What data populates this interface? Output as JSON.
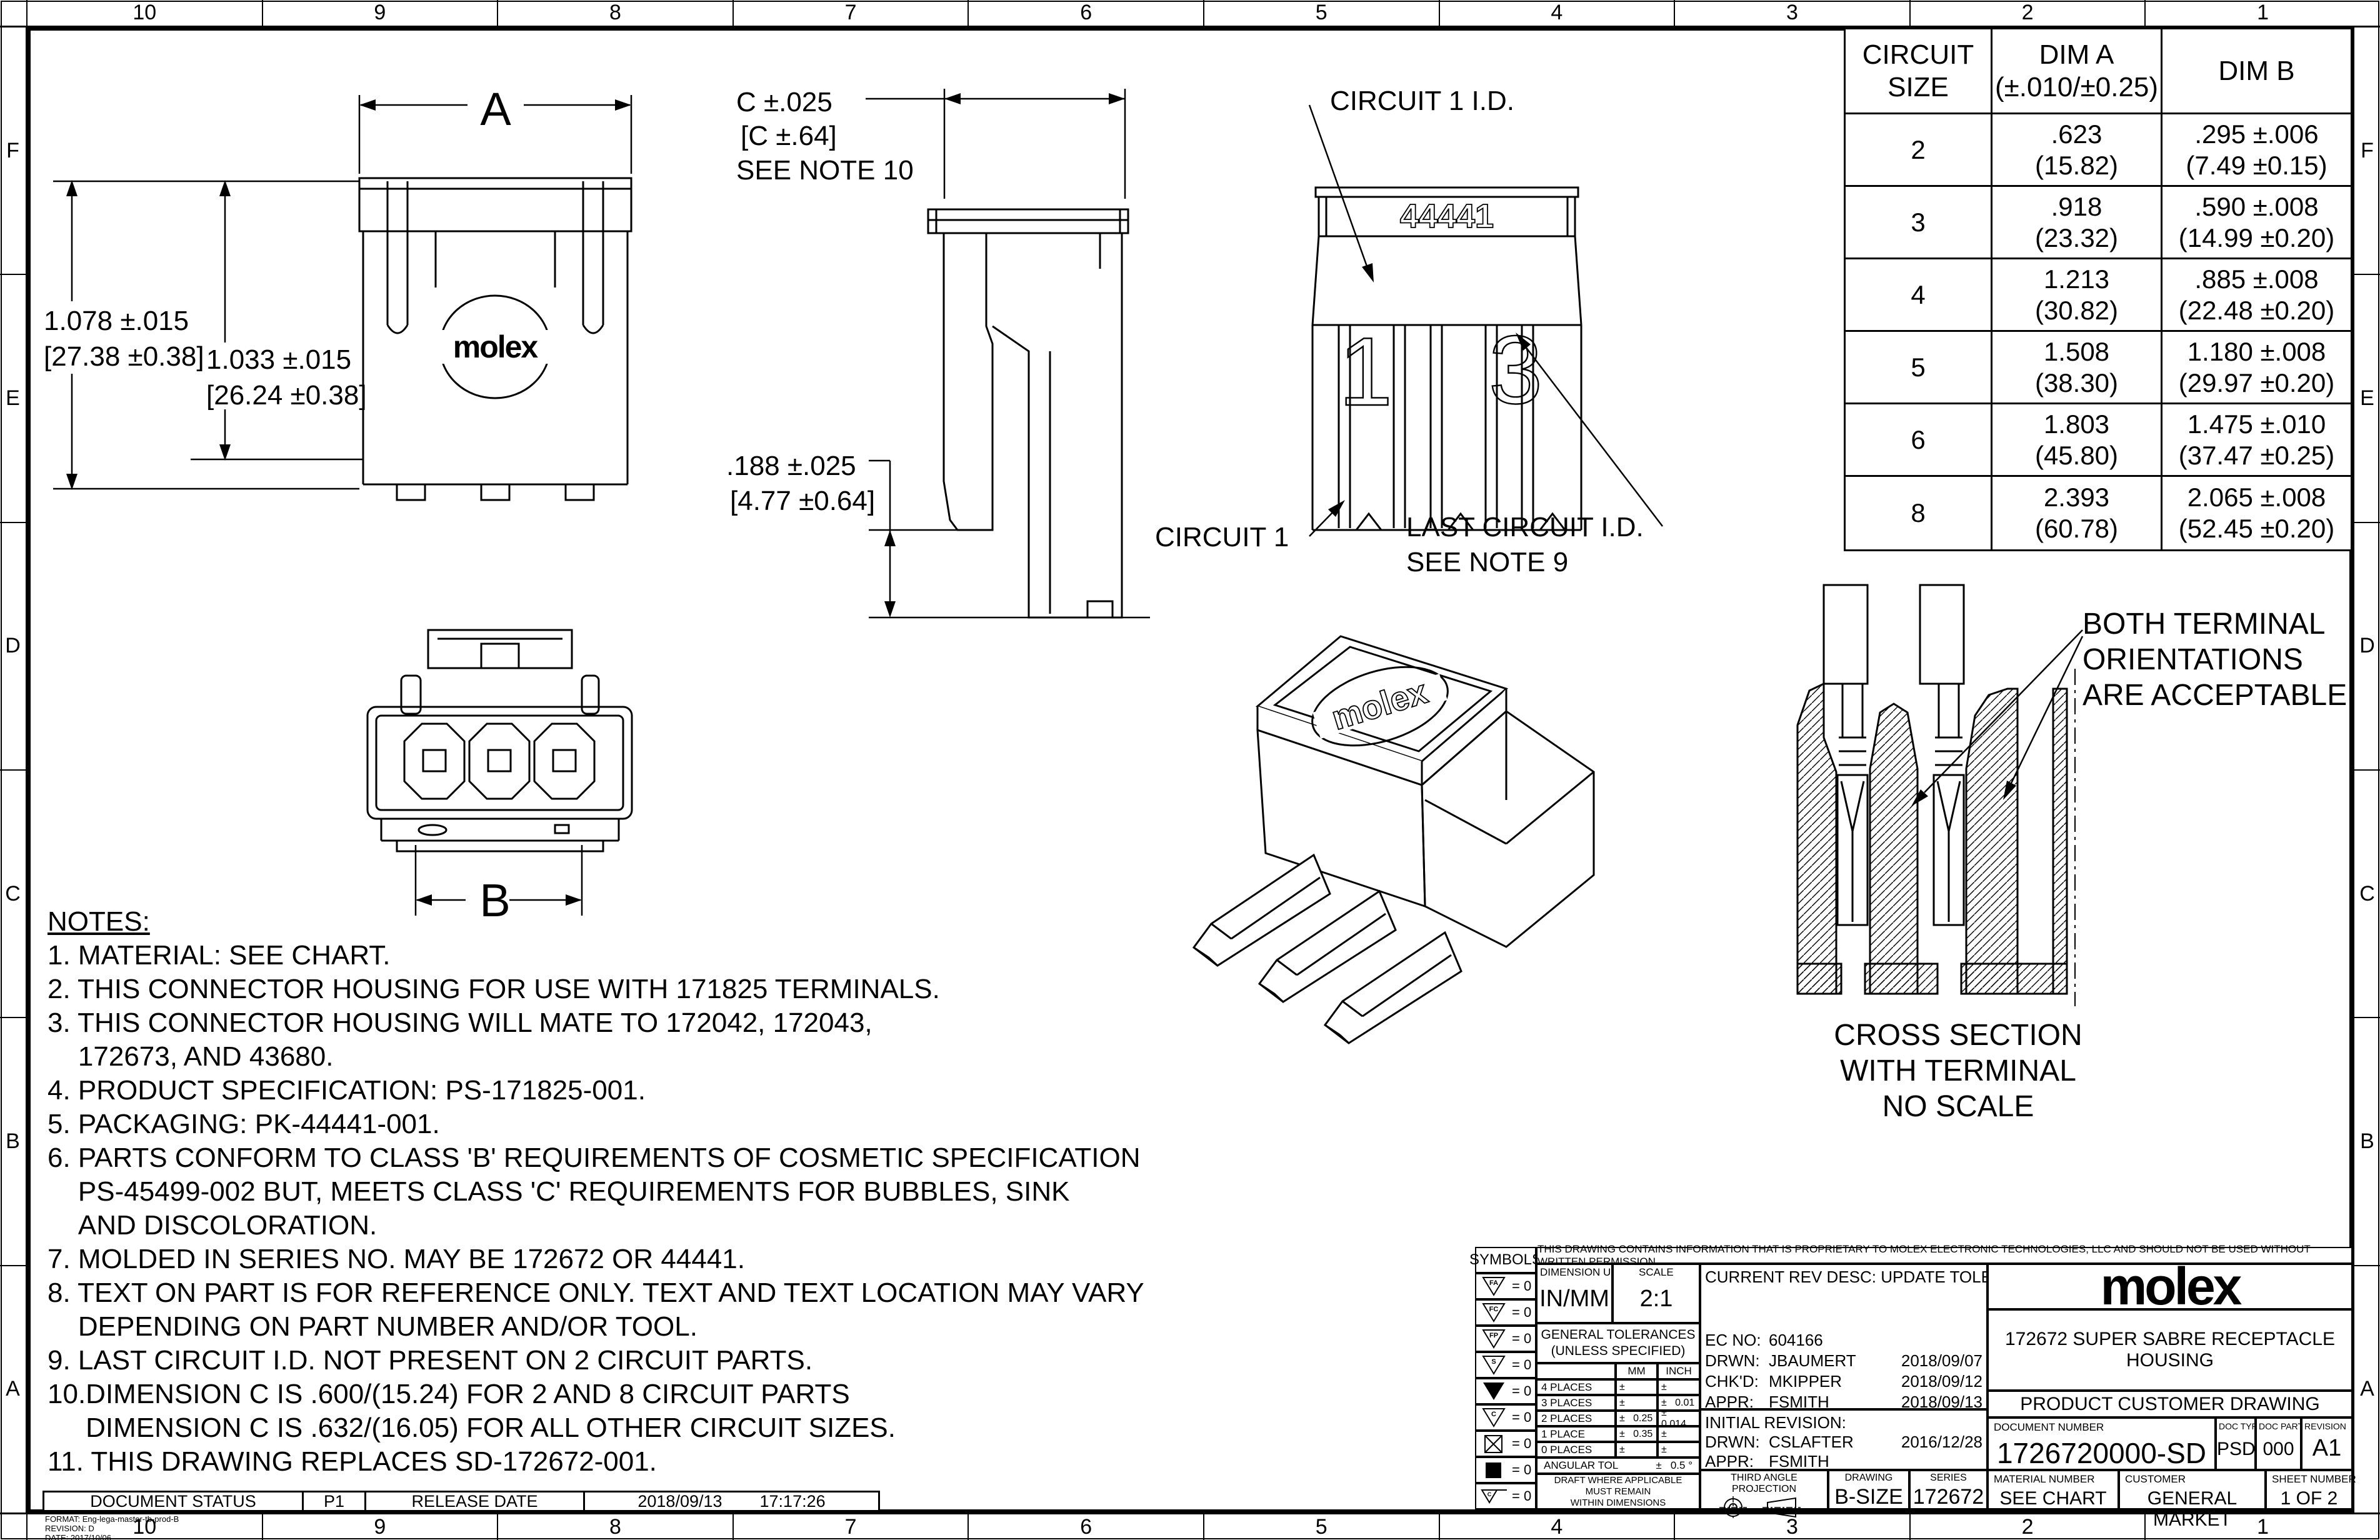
{
  "sheet": {
    "grid": {
      "columns": [
        "10",
        "9",
        "8",
        "7",
        "6",
        "5",
        "4",
        "3",
        "2",
        "1"
      ],
      "rows": [
        "F",
        "E",
        "D",
        "C",
        "B",
        "A"
      ]
    },
    "views": {
      "side": {
        "dim_a": "A",
        "height_outer_in": "1.078 ±.015",
        "height_outer_mm": "[27.38 ±0.38]",
        "height_inner_in": "1.033 ±.015",
        "height_inner_mm": "[26.24 ±0.38]",
        "logo": "molex"
      },
      "profile": {
        "dim_c_in": "C ±.025",
        "dim_c_mm": "[C ±.64]",
        "see_note": "SEE NOTE 10",
        "depth_in": ".188 ±.025",
        "depth_mm": "[4.77 ±0.64]"
      },
      "face": {
        "circuit1_id_label": "CIRCUIT 1 I.D.",
        "molded_series": "44441",
        "molded_first": "1",
        "molded_last": "3",
        "circuit1_label": "CIRCUIT 1",
        "last_circuit_label": "LAST CIRCUIT I.D.",
        "last_circuit_note": "SEE NOTE 9"
      },
      "front": {
        "dim_b": "B"
      },
      "iso": {
        "logo": "molex"
      },
      "cross_section": {
        "callout": "BOTH TERMINAL\nORIENTATIONS\nARE ACCEPTABLE",
        "caption": "CROSS SECTION\nWITH TERMINAL\nNO SCALE"
      }
    },
    "table": {
      "header": {
        "col1": "CIRCUIT\nSIZE",
        "col2a": "DIM A",
        "col2b": "(±.010/±0.25)",
        "col3": "DIM B"
      },
      "rows": [
        {
          "size": "2",
          "a_in": ".623",
          "a_mm": "(15.82)",
          "b_in": ".295 ±.006",
          "b_mm": "(7.49 ±0.15)"
        },
        {
          "size": "3",
          "a_in": ".918",
          "a_mm": "(23.32)",
          "b_in": ".590 ±.008",
          "b_mm": "(14.99 ±0.20)"
        },
        {
          "size": "4",
          "a_in": "1.213",
          "a_mm": "(30.82)",
          "b_in": ".885 ±.008",
          "b_mm": "(22.48 ±0.20)"
        },
        {
          "size": "5",
          "a_in": "1.508",
          "a_mm": "(38.30)",
          "b_in": "1.180 ±.008",
          "b_mm": "(29.97 ±0.20)"
        },
        {
          "size": "6",
          "a_in": "1.803",
          "a_mm": "(45.80)",
          "b_in": "1.475 ±.010",
          "b_mm": "(37.47 ±0.25)"
        },
        {
          "size": "8",
          "a_in": "2.393",
          "a_mm": "(60.78)",
          "b_in": "2.065 ±.008",
          "b_mm": "(52.45 ±0.20)"
        }
      ]
    },
    "notes": {
      "heading": "NOTES:",
      "items": [
        "1. MATERIAL: SEE CHART.",
        "2. THIS CONNECTOR HOUSING FOR USE WITH 171825 TERMINALS.",
        "3. THIS CONNECTOR HOUSING WILL MATE TO 172042, 172043,\n    172673, AND 43680.",
        "4. PRODUCT SPECIFICATION: PS-171825-001.",
        "5. PACKAGING: PK-44441-001.",
        "6. PARTS CONFORM TO CLASS 'B' REQUIREMENTS OF COSMETIC SPECIFICATION\n    PS-45499-002 BUT, MEETS CLASS 'C' REQUIREMENTS FOR BUBBLES, SINK\n    AND DISCOLORATION.",
        "7. MOLDED IN SERIES NO. MAY BE 172672 OR 44441.",
        "8. TEXT ON PART IS FOR REFERENCE ONLY. TEXT AND TEXT LOCATION MAY VARY\n    DEPENDING ON PART NUMBER AND/OR TOOL.",
        "9. LAST CIRCUIT I.D. NOT PRESENT ON 2 CIRCUIT PARTS.",
        "10.DIMENSION C IS .600/(15.24) FOR 2 AND 8 CIRCUIT PARTS\n     DIMENSION C IS .632/(16.05) FOR ALL OTHER CIRCUIT SIZES.",
        "11. THIS DRAWING REPLACES SD-172672-001."
      ]
    },
    "title_block": {
      "proprietary": "THIS DRAWING CONTAINS INFORMATION THAT IS PROPRIETARY TO MOLEX ELECTRONIC TECHNOLOGIES, LLC AND SHOULD NOT BE USED WITHOUT WRITTEN PERMISSION",
      "symbols": {
        "heading": "SYMBOLS",
        "items": [
          {
            "glyph": "FA",
            "value": "= 0"
          },
          {
            "glyph": "FC",
            "value": "= 0"
          },
          {
            "glyph": "FP",
            "value": "= 0"
          },
          {
            "glyph": "S",
            "value": "= 0"
          },
          {
            "glyph": "",
            "value": "= 0"
          },
          {
            "glyph": "C",
            "value": "= 0"
          },
          {
            "glyph": "",
            "value": "= 0"
          },
          {
            "glyph": "",
            "value": "= 0"
          },
          {
            "glyph": "C",
            "value": "= 0"
          }
        ]
      },
      "units": {
        "label": "DIMENSION UNITS",
        "value": "IN/MM"
      },
      "scale": {
        "label": "SCALE",
        "value": "2:1"
      },
      "general_tol": "GENERAL TOLERANCES\n(UNLESS SPECIFIED)",
      "tol_table": {
        "mm": "MM",
        "inch": "INCH",
        "rows": [
          {
            "label": "4 PLACES",
            "mm": "±",
            "inch": "±"
          },
          {
            "label": "3 PLACES",
            "mm": "±",
            "inch": "±   0.01"
          },
          {
            "label": "2 PLACES",
            "mm": "±   0.25",
            "inch": "±   0.014"
          },
          {
            "label": "1 PLACE",
            "mm": "±   0.35",
            "inch": "±"
          },
          {
            "label": "0 PLACES",
            "mm": "±",
            "inch": "±"
          }
        ],
        "angular_label": "ANGULAR TOL",
        "angular_value": "±   0.5 °"
      },
      "draft_note": "DRAFT WHERE APPLICABLE\nMUST REMAIN\nWITHIN DIMENSIONS",
      "current_rev": "CURRENT REV DESC: UPDATE TOLERANCES",
      "ec_no": {
        "label": "EC NO:",
        "value": "604166"
      },
      "drawn1": {
        "label": "DRWN:",
        "value": "JBAUMERT",
        "date": "2018/09/07"
      },
      "checked": {
        "label": "CHK'D:",
        "value": "MKIPPER",
        "date": "2018/09/12"
      },
      "approved1": {
        "label": "APPR:",
        "value": "FSMITH",
        "date": "2018/09/13"
      },
      "initial_revision": "INITIAL REVISION:",
      "drawn2": {
        "label": "DRWN:",
        "value": "CSLAFTER",
        "date": "2016/12/28"
      },
      "approved2": {
        "label": "APPR:",
        "value": "FSMITH"
      },
      "third_angle": "THIRD ANGLE PROJECTION",
      "drawing": {
        "label": "DRAWING",
        "value": "B-SIZE"
      },
      "series": {
        "label": "SERIES",
        "value": "172672"
      },
      "material": {
        "label": "MATERIAL NUMBER",
        "value": "SEE CHART"
      },
      "customer": {
        "label": "CUSTOMER",
        "value": "GENERAL MARKET"
      },
      "sheet_number": {
        "label": "SHEET NUMBER",
        "value": "1 OF 2"
      },
      "brand": "molex",
      "part_title": "172672 SUPER SABRE RECEPTACLE HOUSING",
      "doc_title": "PRODUCT CUSTOMER DRAWING",
      "document_number": {
        "label": "DOCUMENT NUMBER",
        "value": "1726720000-SD"
      },
      "doc_type": {
        "label": "DOC TYPE",
        "value": "PSD"
      },
      "doc_part": {
        "label": "DOC PART",
        "value": "000"
      },
      "revision": {
        "label": "REVISION",
        "value": "A1"
      }
    },
    "status_bar": {
      "document_status_label": "DOCUMENT STATUS",
      "status": "P1",
      "release_date_label": "RELEASE DATE",
      "date": "2018/09/13",
      "time": "17:17:26"
    },
    "fine_print": {
      "format": "FORMAT: Eng-lega-master-tb-prod-B",
      "revision": "REVISION: D",
      "date": "DATE: 2017/10/06"
    }
  }
}
